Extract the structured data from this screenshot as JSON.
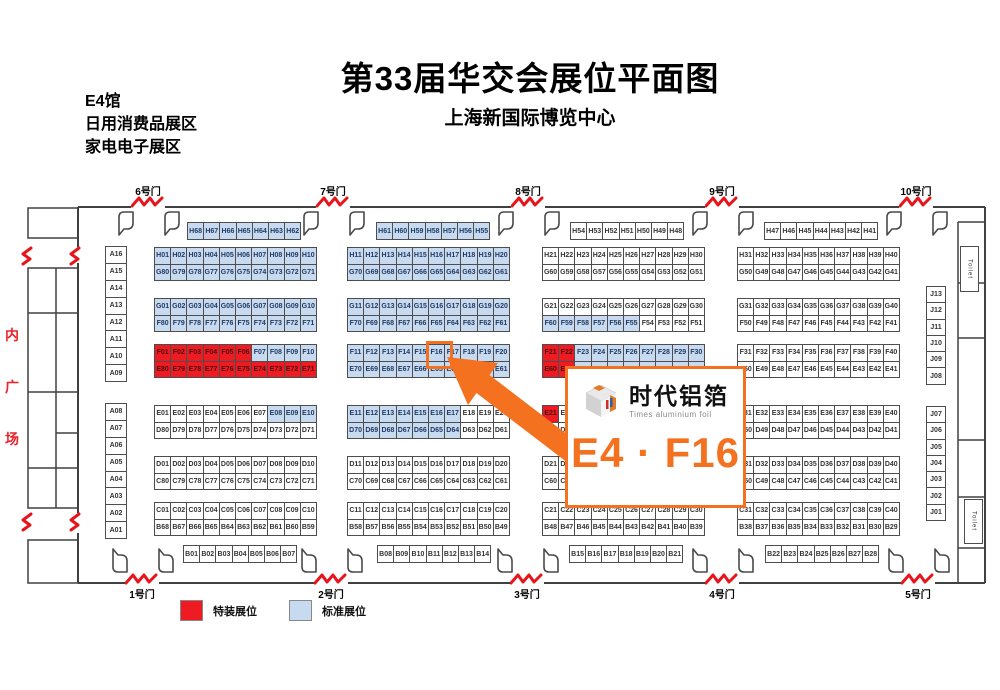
{
  "title": "第33届华交会展位平面图",
  "subtitle": "上海新国际博览中心",
  "hall_info": [
    "E4馆",
    "日用消费品展区",
    "家电电子展区"
  ],
  "plaza_chars": [
    "内",
    "广",
    "场"
  ],
  "toilet_label": "Toilet",
  "legend": {
    "items": [
      {
        "label": "特装展位",
        "type": "special",
        "color": "#ee1b22"
      },
      {
        "label": "标准展位",
        "type": "standard",
        "color": "#c8daf0"
      }
    ]
  },
  "callout": {
    "brand_cn": "时代铝箔",
    "brand_en": "Times aluminium foil",
    "booth_text": "E4 · F16",
    "highlighted_booth": "F16",
    "accent_color": "#f4711f"
  },
  "colors": {
    "standard_booth": "#c8daf0",
    "special_booth": "#ee1b22",
    "gate_mark": "#e8141c",
    "wall": "#404040",
    "plaza_text": "#e8232a"
  },
  "map": {
    "gates": {
      "top": [
        {
          "label": "6号门",
          "x": 148
        },
        {
          "label": "7号门",
          "x": 333
        },
        {
          "label": "8号门",
          "x": 528
        },
        {
          "label": "9号门",
          "x": 722
        },
        {
          "label": "10号门",
          "x": 916
        }
      ],
      "bottom": [
        {
          "label": "1号门",
          "x": 142
        },
        {
          "label": "2号门",
          "x": 331
        },
        {
          "label": "3号门",
          "x": 527
        },
        {
          "label": "4号门",
          "x": 722
        },
        {
          "label": "5号门",
          "x": 918
        }
      ]
    },
    "grids": [
      {
        "x": 187,
        "y": 222,
        "cols": 7,
        "ch": 16,
        "fill": "s",
        "cells": [
          "H68",
          "H67",
          "H66",
          "H65",
          "H64",
          "H63",
          "H62"
        ]
      },
      {
        "x": 376,
        "y": 222,
        "cols": 7,
        "ch": 16,
        "fill": "s",
        "cells": [
          "H61",
          "H60",
          "H59",
          "H58",
          "H57",
          "H56",
          "H55"
        ]
      },
      {
        "x": 570,
        "y": 222,
        "cols": 7,
        "ch": 16,
        "fill": "w",
        "cells": [
          "H54",
          "H53",
          "H52",
          "H51",
          "H50",
          "H49",
          "H48"
        ]
      },
      {
        "x": 764,
        "y": 222,
        "cols": 7,
        "ch": 16,
        "fill": "w",
        "cells": [
          "H47",
          "H46",
          "H45",
          "H44",
          "H43",
          "H42",
          "H41"
        ]
      },
      {
        "x": 154,
        "y": 247,
        "cols": 10,
        "fill": "s",
        "cells": [
          "H01",
          "H02",
          "H03",
          "H04",
          "H05",
          "H06",
          "H07",
          "H08",
          "H09",
          "H10",
          "G80",
          "G79",
          "G78",
          "G77",
          "G76",
          "G75",
          "G74",
          "G73",
          "G72",
          "G71"
        ]
      },
      {
        "x": 154,
        "y": 298,
        "cols": 10,
        "fill": "s",
        "cells": [
          "G01",
          "G02",
          "G03",
          "G04",
          "G05",
          "G06",
          "G07",
          "G08",
          "G09",
          "G10",
          "F80",
          "F79",
          "F78",
          "F77",
          "F76",
          "F75",
          "F74",
          "F73",
          "F72",
          "F71"
        ]
      },
      {
        "x": 154,
        "y": 344,
        "cols": 10,
        "fill": "rrrrrrssssrrrrrrrrrr",
        "cells": [
          "F01",
          "F02",
          "F03",
          "F04",
          "F05",
          "F06",
          "F07",
          "F08",
          "F09",
          "F10",
          "E80",
          "E79",
          "E78",
          "E77",
          "E76",
          "E75",
          "E74",
          "E73",
          "E72",
          "E71"
        ]
      },
      {
        "x": 154,
        "y": 405,
        "cols": 10,
        "fill": "wwwwwwwssswwwwwwwwww",
        "cells": [
          "E01",
          "E02",
          "E03",
          "E04",
          "E05",
          "E06",
          "E07",
          "E08",
          "E09",
          "E10",
          "D80",
          "D79",
          "D78",
          "D77",
          "D76",
          "D75",
          "D74",
          "D73",
          "D72",
          "D71"
        ]
      },
      {
        "x": 154,
        "y": 456,
        "cols": 10,
        "fill": "w",
        "cells": [
          "D01",
          "D02",
          "D03",
          "D04",
          "D05",
          "D06",
          "D07",
          "D08",
          "D09",
          "D10",
          "C80",
          "C79",
          "C78",
          "C77",
          "C76",
          "C75",
          "C74",
          "C73",
          "C72",
          "C71"
        ]
      },
      {
        "x": 154,
        "y": 502,
        "cols": 10,
        "fill": "w",
        "cells": [
          "C01",
          "C02",
          "C03",
          "C04",
          "C05",
          "C06",
          "C07",
          "C08",
          "C09",
          "C10",
          "B68",
          "B67",
          "B66",
          "B65",
          "B64",
          "B63",
          "B62",
          "B61",
          "B60",
          "B59"
        ]
      },
      {
        "x": 347,
        "y": 247,
        "cols": 10,
        "fill": "s",
        "cells": [
          "H11",
          "H12",
          "H13",
          "H14",
          "H15",
          "H16",
          "H17",
          "H18",
          "H19",
          "H20",
          "G70",
          "G69",
          "G68",
          "G67",
          "G66",
          "G65",
          "G64",
          "G63",
          "G62",
          "G61"
        ]
      },
      {
        "x": 347,
        "y": 298,
        "cols": 10,
        "fill": "s",
        "cells": [
          "G11",
          "G12",
          "G13",
          "G14",
          "G15",
          "G16",
          "G17",
          "G18",
          "G19",
          "G20",
          "F70",
          "F69",
          "F68",
          "F67",
          "F66",
          "F65",
          "F64",
          "F63",
          "F62",
          "F61"
        ]
      },
      {
        "x": 347,
        "y": 344,
        "cols": 10,
        "fill": "s",
        "cells": [
          "F11",
          "F12",
          "F13",
          "F14",
          "F15",
          "F16",
          "F17",
          "F18",
          "F19",
          "F20",
          "E70",
          "E69",
          "E68",
          "E67",
          "E66",
          "E65",
          "E64",
          "E63",
          "E62",
          "E61"
        ]
      },
      {
        "x": 347,
        "y": 405,
        "cols": 10,
        "fill": "ssssssswwwssssssswww",
        "cells": [
          "E11",
          "E12",
          "E13",
          "E14",
          "E15",
          "E16",
          "E17",
          "E18",
          "E19",
          "E20",
          "D70",
          "D69",
          "D68",
          "D67",
          "D66",
          "D65",
          "D64",
          "D63",
          "D62",
          "D61"
        ]
      },
      {
        "x": 347,
        "y": 456,
        "cols": 10,
        "fill": "w",
        "cells": [
          "D11",
          "D12",
          "D13",
          "D14",
          "D15",
          "D16",
          "D17",
          "D18",
          "D19",
          "D20",
          "C70",
          "C69",
          "C68",
          "C67",
          "C66",
          "C65",
          "C64",
          "C63",
          "C62",
          "C61"
        ]
      },
      {
        "x": 347,
        "y": 502,
        "cols": 10,
        "fill": "w",
        "cells": [
          "C11",
          "C12",
          "C13",
          "C14",
          "C15",
          "C16",
          "C17",
          "C18",
          "C19",
          "C20",
          "B58",
          "B57",
          "B56",
          "B55",
          "B54",
          "B53",
          "B52",
          "B51",
          "B50",
          "B49"
        ]
      },
      {
        "x": 542,
        "y": 247,
        "cols": 10,
        "fill": "w",
        "cells": [
          "H21",
          "H22",
          "H23",
          "H24",
          "H25",
          "H26",
          "H27",
          "H28",
          "H29",
          "H30",
          "G60",
          "G59",
          "G58",
          "G57",
          "G56",
          "G55",
          "G54",
          "G53",
          "G52",
          "G51"
        ]
      },
      {
        "x": 542,
        "y": 298,
        "cols": 10,
        "fill": "wwwwwwwwwwsssssswwww",
        "cells": [
          "G21",
          "G22",
          "G23",
          "G24",
          "G25",
          "G26",
          "G27",
          "G28",
          "G29",
          "G30",
          "F60",
          "F59",
          "F58",
          "F57",
          "F56",
          "F55",
          "F54",
          "F53",
          "F52",
          "F51"
        ]
      },
      {
        "x": 542,
        "y": 344,
        "cols": 10,
        "fill": "rrssssssssrrssssssss",
        "cells": [
          "F21",
          "F22",
          "F23",
          "F24",
          "F25",
          "F26",
          "F27",
          "F28",
          "F29",
          "F30",
          "E60",
          "E59",
          "E58",
          "E57",
          "E56",
          "E55",
          "E54",
          "E53",
          "E52",
          "E51"
        ]
      },
      {
        "x": 542,
        "y": 405,
        "cols": 10,
        "fill": "rwwwwwwwwwwwwwwwwwww",
        "cells": [
          "E21",
          "E22",
          "E23",
          "E24",
          "E25",
          "E26",
          "E27",
          "E28",
          "E29",
          "E30",
          "D60",
          "D59",
          "D58",
          "D57",
          "D56",
          "D55",
          "D54",
          "D53",
          "D52",
          "D51"
        ]
      },
      {
        "x": 542,
        "y": 456,
        "cols": 10,
        "fill": "w",
        "cells": [
          "D21",
          "D22",
          "D23",
          "D24",
          "D25",
          "D26",
          "D27",
          "D28",
          "D29",
          "D30",
          "C60",
          "C59",
          "C58",
          "C57",
          "C56",
          "C55",
          "C54",
          "C53",
          "C52",
          "C51"
        ]
      },
      {
        "x": 542,
        "y": 502,
        "cols": 10,
        "fill": "w",
        "cells": [
          "C21",
          "C22",
          "C23",
          "C24",
          "C25",
          "C26",
          "C27",
          "C28",
          "C29",
          "C30",
          "B48",
          "B47",
          "B46",
          "B45",
          "B44",
          "B43",
          "B42",
          "B41",
          "B40",
          "B39"
        ]
      },
      {
        "x": 737,
        "y": 247,
        "cols": 10,
        "fill": "w",
        "cells": [
          "H31",
          "H32",
          "H33",
          "H34",
          "H35",
          "H36",
          "H37",
          "H38",
          "H39",
          "H40",
          "G50",
          "G49",
          "G48",
          "G47",
          "G46",
          "G45",
          "G44",
          "G43",
          "G42",
          "G41"
        ]
      },
      {
        "x": 737,
        "y": 298,
        "cols": 10,
        "fill": "w",
        "cells": [
          "G31",
          "G32",
          "G33",
          "G34",
          "G35",
          "G36",
          "G37",
          "G38",
          "G39",
          "G40",
          "F50",
          "F49",
          "F48",
          "F47",
          "F46",
          "F45",
          "F44",
          "F43",
          "F42",
          "F41"
        ]
      },
      {
        "x": 737,
        "y": 344,
        "cols": 10,
        "fill": "w",
        "cells": [
          "F31",
          "F32",
          "F33",
          "F34",
          "F35",
          "F36",
          "F37",
          "F38",
          "F39",
          "F40",
          "E50",
          "E49",
          "E48",
          "E47",
          "E46",
          "E45",
          "E44",
          "E43",
          "E42",
          "E41"
        ]
      },
      {
        "x": 737,
        "y": 405,
        "cols": 10,
        "fill": "w",
        "cells": [
          "E31",
          "E32",
          "E33",
          "E34",
          "E35",
          "E36",
          "E37",
          "E38",
          "E39",
          "E40",
          "D50",
          "D49",
          "D48",
          "D47",
          "D46",
          "D45",
          "D44",
          "D43",
          "D42",
          "D41"
        ]
      },
      {
        "x": 737,
        "y": 456,
        "cols": 10,
        "fill": "w",
        "cells": [
          "D31",
          "D32",
          "D33",
          "D34",
          "D35",
          "D36",
          "D37",
          "D38",
          "D39",
          "D40",
          "C50",
          "C49",
          "C48",
          "C47",
          "C46",
          "C45",
          "C44",
          "C43",
          "C42",
          "C41"
        ]
      },
      {
        "x": 737,
        "y": 502,
        "cols": 10,
        "fill": "w",
        "cells": [
          "C31",
          "C32",
          "C33",
          "C34",
          "C35",
          "C36",
          "C37",
          "C38",
          "C39",
          "C40",
          "B38",
          "B37",
          "B36",
          "B35",
          "B34",
          "B33",
          "B32",
          "B31",
          "B30",
          "B29"
        ]
      },
      {
        "x": 183,
        "y": 545,
        "cols": 7,
        "ch": 16,
        "fill": "w",
        "cells": [
          "B01",
          "B02",
          "B03",
          "B04",
          "B05",
          "B06",
          "B07"
        ]
      },
      {
        "x": 377,
        "y": 545,
        "cols": 7,
        "ch": 16,
        "fill": "w",
        "cells": [
          "B08",
          "B09",
          "B10",
          "B11",
          "B12",
          "B13",
          "B14"
        ]
      },
      {
        "x": 569,
        "y": 545,
        "cols": 7,
        "ch": 16,
        "fill": "w",
        "cells": [
          "B15",
          "B16",
          "B17",
          "B18",
          "B19",
          "B20",
          "B21"
        ]
      },
      {
        "x": 765,
        "y": 545,
        "cols": 7,
        "ch": 16,
        "fill": "w",
        "cells": [
          "B22",
          "B23",
          "B24",
          "B25",
          "B26",
          "B27",
          "B28"
        ]
      },
      {
        "x": 105,
        "y": 246,
        "cols": 1,
        "cw": 20,
        "ch": 15.9,
        "fill": "w",
        "cells": [
          "A16",
          "A15",
          "A14",
          "A13",
          "A12",
          "A11",
          "A10",
          "A09"
        ]
      },
      {
        "x": 105,
        "y": 403,
        "cols": 1,
        "cw": 20,
        "ch": 15.9,
        "fill": "w",
        "cells": [
          "A08",
          "A07",
          "A06",
          "A05",
          "A04",
          "A03",
          "A02",
          "A01"
        ]
      },
      {
        "x": 926,
        "y": 286,
        "cols": 1,
        "cw": 18,
        "ch": 15.3,
        "fill": "w",
        "cells": [
          "J13",
          "J12",
          "J11",
          "J10",
          "J09",
          "J08"
        ]
      },
      {
        "x": 926,
        "y": 406,
        "cols": 1,
        "cw": 18,
        "ch": 15.3,
        "fill": "w",
        "cells": [
          "J07",
          "J06",
          "J05",
          "J04",
          "J03",
          "J02",
          "J01"
        ]
      }
    ]
  }
}
